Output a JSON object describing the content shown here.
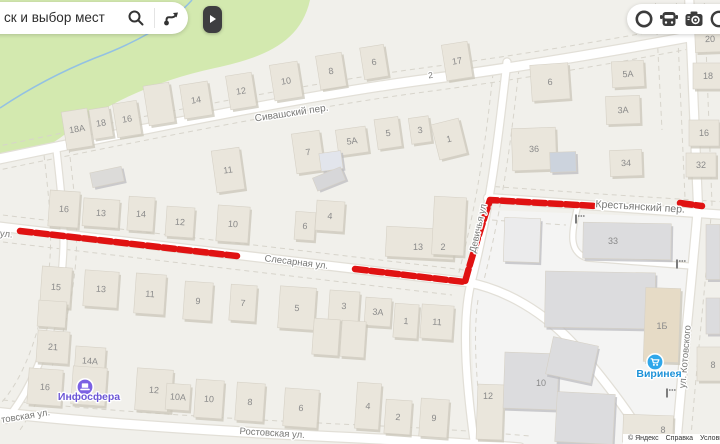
{
  "search": {
    "query": "ск и выбор мест"
  },
  "panel": {
    "expand": "open-panel"
  },
  "layers_bar": {
    "icons": [
      "traffic-ring",
      "transport",
      "road-camera",
      "bookmark-partial"
    ]
  },
  "attribution": {
    "items": [
      "© Яндекс",
      "Справка",
      "Условия"
    ]
  },
  "map": {
    "street_labels": [
      {
        "t": "Сивашский пер.",
        "x": 292,
        "y": 116,
        "r": -8.5,
        "s": 10
      },
      {
        "t": "Слесарная ул.",
        "x": 296,
        "y": 265,
        "r": 6.8,
        "s": 9.5
      },
      {
        "t": "Девичья ул",
        "x": 481,
        "y": 229,
        "r": -77,
        "s": 9.5
      },
      {
        "t": "Крестьянский пер.",
        "x": 640,
        "y": 210,
        "r": 3.5,
        "s": 10.5
      },
      {
        "t": "ул. Котовского",
        "x": 688,
        "y": 357,
        "r": -85,
        "s": 9.5
      },
      {
        "t": "Ростовская ул.",
        "x": 272,
        "y": 436,
        "r": 3.5,
        "s": 9.5
      },
      {
        "t": "товская ул.",
        "x": 26,
        "y": 419,
        "r": -9,
        "s": 9.5
      },
      {
        "t": "ул.",
        "x": 6,
        "y": 237,
        "r": 6,
        "s": 9.5
      },
      {
        "t": "2",
        "x": 431,
        "y": 78,
        "r": -8,
        "s": 8.5
      }
    ],
    "buildings": [
      {
        "n": "18А",
        "x": 77,
        "y": 129,
        "w": 26,
        "h": 38,
        "r": -9
      },
      {
        "n": "18",
        "x": 101,
        "y": 123,
        "w": 20,
        "h": 30,
        "r": -9
      },
      {
        "n": "16",
        "x": 127,
        "y": 119,
        "w": 24,
        "h": 34,
        "r": -9
      },
      {
        "n": "",
        "x": 159,
        "y": 104,
        "w": 26,
        "h": 40,
        "r": -9
      },
      {
        "n": "14",
        "x": 196,
        "y": 100,
        "w": 28,
        "h": 34,
        "r": -9
      },
      {
        "n": "12",
        "x": 241,
        "y": 91,
        "w": 26,
        "h": 34,
        "r": -9
      },
      {
        "n": "10",
        "x": 286,
        "y": 81,
        "w": 28,
        "h": 36,
        "r": -9
      },
      {
        "n": "8",
        "x": 331,
        "y": 71,
        "w": 26,
        "h": 34,
        "r": -9
      },
      {
        "n": "6",
        "x": 374,
        "y": 62,
        "w": 24,
        "h": 32,
        "r": -9
      },
      {
        "n": "17",
        "x": 457,
        "y": 61,
        "w": 26,
        "h": 36,
        "r": -9
      },
      {
        "n": "11",
        "x": 228,
        "y": 170,
        "w": 28,
        "h": 42,
        "r": -8
      },
      {
        "n": "7",
        "x": 308,
        "y": 152,
        "w": 28,
        "h": 40,
        "r": -8
      },
      {
        "n": "5А",
        "x": 352,
        "y": 141,
        "w": 30,
        "h": 26,
        "r": -8
      },
      {
        "n": "5",
        "x": 388,
        "y": 133,
        "w": 24,
        "h": 30,
        "r": -8
      },
      {
        "n": "3",
        "x": 420,
        "y": 130,
        "w": 20,
        "h": 26,
        "r": -8
      },
      {
        "n": "1",
        "x": 449,
        "y": 139,
        "w": 28,
        "h": 36,
        "r": -14
      },
      {
        "n": "",
        "x": 331,
        "y": 161,
        "w": 22,
        "h": 18,
        "r": -8,
        "f": "#e2e5ec"
      },
      {
        "n": "6",
        "x": 550,
        "y": 82,
        "w": 38,
        "h": 36,
        "r": -4
      },
      {
        "n": "5А",
        "x": 628,
        "y": 74,
        "w": 32,
        "h": 26,
        "r": -3
      },
      {
        "n": "3А",
        "x": 623,
        "y": 110,
        "w": 34,
        "h": 28,
        "r": -2
      },
      {
        "n": "36",
        "x": 534,
        "y": 149,
        "w": 44,
        "h": 42,
        "r": -2
      },
      {
        "n": "",
        "x": 563,
        "y": 162,
        "w": 26,
        "h": 20,
        "r": -2,
        "f": "#ccd3dd"
      },
      {
        "n": "34",
        "x": 626,
        "y": 163,
        "w": 32,
        "h": 26,
        "r": -2
      },
      {
        "n": "20",
        "x": 710,
        "y": 39,
        "w": 30,
        "h": 26,
        "r": -2
      },
      {
        "n": "18",
        "x": 708,
        "y": 76,
        "w": 30,
        "h": 26,
        "r": 0
      },
      {
        "n": "16",
        "x": 704,
        "y": 133,
        "w": 30,
        "h": 26,
        "r": 0
      },
      {
        "n": "32",
        "x": 701,
        "y": 165,
        "w": 30,
        "h": 24,
        "r": 0
      },
      {
        "n": "",
        "x": 107,
        "y": 177,
        "w": 32,
        "h": 15,
        "r": -12,
        "f": "#dcdbd9"
      },
      {
        "n": "16",
        "x": 64,
        "y": 209,
        "w": 30,
        "h": 36,
        "r": 4
      },
      {
        "n": "13",
        "x": 101,
        "y": 213,
        "w": 36,
        "h": 28,
        "r": 4
      },
      {
        "n": "14",
        "x": 141,
        "y": 214,
        "w": 26,
        "h": 34,
        "r": 4
      },
      {
        "n": "12",
        "x": 180,
        "y": 222,
        "w": 28,
        "h": 30,
        "r": 4
      },
      {
        "n": "10",
        "x": 233,
        "y": 224,
        "w": 32,
        "h": 36,
        "r": 4
      },
      {
        "n": "",
        "x": 329,
        "y": 179,
        "w": 30,
        "h": 14,
        "r": -22,
        "f": "#d7d7d9"
      },
      {
        "n": "6",
        "x": 305,
        "y": 226,
        "w": 20,
        "h": 28,
        "r": 4
      },
      {
        "n": "4",
        "x": 330,
        "y": 216,
        "w": 28,
        "h": 30,
        "r": 4
      },
      {
        "n": "13",
        "x": 420,
        "y": 243,
        "w": 68,
        "h": 30,
        "r": 3,
        "lx": 418,
        "ly": 247
      },
      {
        "n": "2",
        "x": 449,
        "y": 226,
        "w": 32,
        "h": 58,
        "r": 3,
        "lx": 443,
        "ly": 247
      },
      {
        "n": "33",
        "x": 627,
        "y": 241,
        "w": 88,
        "h": 36,
        "r": 1,
        "f": "#dcdcde",
        "lx": 613,
        "ly": 241
      },
      {
        "n": "15",
        "x": 56,
        "y": 287,
        "w": 30,
        "h": 40,
        "r": 4
      },
      {
        "n": "",
        "x": 52,
        "y": 314,
        "w": 28,
        "h": 26,
        "r": 4
      },
      {
        "n": "13",
        "x": 101,
        "y": 289,
        "w": 34,
        "h": 36,
        "r": 4
      },
      {
        "n": "11",
        "x": 150,
        "y": 294,
        "w": 30,
        "h": 40,
        "r": 4
      },
      {
        "n": "9",
        "x": 198,
        "y": 301,
        "w": 28,
        "h": 38,
        "r": 4
      },
      {
        "n": "7",
        "x": 243,
        "y": 303,
        "w": 26,
        "h": 36,
        "r": 4
      },
      {
        "n": "5",
        "x": 297,
        "y": 308,
        "w": 36,
        "h": 42,
        "r": 4
      },
      {
        "n": "3",
        "x": 344,
        "y": 306,
        "w": 30,
        "h": 30,
        "r": 4
      },
      {
        "n": "3А",
        "x": 378,
        "y": 312,
        "w": 26,
        "h": 28,
        "r": 4
      },
      {
        "n": "1",
        "x": 406,
        "y": 321,
        "w": 24,
        "h": 34,
        "r": 4
      },
      {
        "n": "11",
        "x": 437,
        "y": 322,
        "w": 32,
        "h": 34,
        "r": 4
      },
      {
        "n": "",
        "x": 326,
        "y": 337,
        "w": 26,
        "h": 36,
        "r": 4
      },
      {
        "n": "",
        "x": 353,
        "y": 339,
        "w": 24,
        "h": 36,
        "r": 4
      },
      {
        "n": "21",
        "x": 53,
        "y": 347,
        "w": 32,
        "h": 32,
        "r": 4
      },
      {
        "n": "14А",
        "x": 90,
        "y": 361,
        "w": 30,
        "h": 28,
        "r": 4
      },
      {
        "n": "16",
        "x": 45,
        "y": 387,
        "w": 34,
        "h": 36,
        "r": 4
      },
      {
        "n": "",
        "x": 89,
        "y": 386,
        "w": 34,
        "h": 38,
        "r": 4
      },
      {
        "n": "12",
        "x": 154,
        "y": 390,
        "w": 36,
        "h": 42,
        "r": 4
      },
      {
        "n": "10А",
        "x": 178,
        "y": 397,
        "w": 24,
        "h": 26,
        "r": 4
      },
      {
        "n": "10",
        "x": 209,
        "y": 399,
        "w": 28,
        "h": 38,
        "r": 4
      },
      {
        "n": "8",
        "x": 250,
        "y": 402,
        "w": 28,
        "h": 38,
        "r": 4
      },
      {
        "n": "6",
        "x": 301,
        "y": 408,
        "w": 34,
        "h": 38,
        "r": 4
      },
      {
        "n": "4",
        "x": 368,
        "y": 406,
        "w": 24,
        "h": 46,
        "r": 4
      },
      {
        "n": "2",
        "x": 398,
        "y": 417,
        "w": 26,
        "h": 34,
        "r": 4
      },
      {
        "n": "9",
        "x": 434,
        "y": 418,
        "w": 28,
        "h": 38,
        "r": 4
      },
      {
        "n": "12",
        "x": 490,
        "y": 412,
        "w": 26,
        "h": 55,
        "r": 2,
        "lx": 488,
        "ly": 396
      },
      {
        "n": "",
        "x": 522,
        "y": 240,
        "w": 36,
        "h": 44,
        "r": 2,
        "f": "#ebebec"
      },
      {
        "n": "",
        "x": 600,
        "y": 300,
        "w": 110,
        "h": 56,
        "r": 1,
        "f": "#dcdcde"
      },
      {
        "n": "10",
        "x": 531,
        "y": 381,
        "w": 54,
        "h": 56,
        "r": 2,
        "f": "#dcdcde",
        "lx": 541,
        "ly": 383
      },
      {
        "n": "",
        "x": 572,
        "y": 360,
        "w": 46,
        "h": 38,
        "r": 12,
        "f": "#dcdcde"
      },
      {
        "n": "",
        "x": 585,
        "y": 418,
        "w": 58,
        "h": 50,
        "r": 3,
        "f": "#dcdcde"
      },
      {
        "n": "1Б",
        "x": 662,
        "y": 325,
        "w": 35,
        "h": 74,
        "r": 2,
        "f": "#e6dbc6",
        "lx": 662,
        "ly": 326
      },
      {
        "n": "8",
        "x": 648,
        "y": 429,
        "w": 50,
        "h": 28,
        "r": 2,
        "lx": 663,
        "ly": 430
      },
      {
        "n": "8",
        "x": 709,
        "y": 364,
        "w": 24,
        "h": 34,
        "r": 0,
        "lx": 713,
        "ly": 365
      },
      {
        "n": "",
        "x": 713,
        "y": 252,
        "w": 14,
        "h": 55,
        "r": 0,
        "f": "#dcdcde"
      },
      {
        "n": "",
        "x": 713,
        "y": 316,
        "w": 14,
        "h": 36,
        "r": 0,
        "f": "#dcdcde"
      }
    ],
    "pois": [
      {
        "name": "Инфосфера",
        "x": 85,
        "y": 387,
        "ly": 400,
        "color": "#7B61E3",
        "label_color": "#6c57d6",
        "glyph": "laptop"
      },
      {
        "name": "Виринея",
        "x": 655,
        "y": 362,
        "ly": 377,
        "color": "#2FA7EA",
        "label_color": "#1d92d8",
        "glyph": "cart"
      }
    ],
    "route": {
      "color": "#e01212",
      "segments": [
        "M 20,231 L 237,256",
        "M 355,269 L 465,282 C 472,256 483,222 490,200 L 596,206",
        "M 680,203 L 702,206"
      ]
    },
    "barriers": [
      {
        "x": 576,
        "y": 219
      },
      {
        "x": 677,
        "y": 264
      },
      {
        "x": 667,
        "y": 393
      }
    ]
  }
}
